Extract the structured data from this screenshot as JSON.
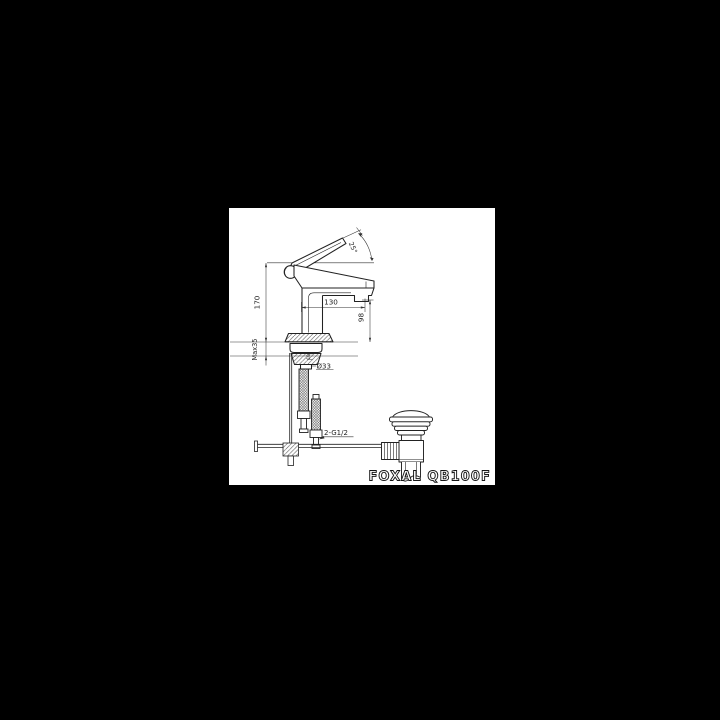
{
  "colors": {
    "background": "#000000",
    "paper": "#ffffff",
    "ink": "#1f1f1f",
    "dim_line": "#333333"
  },
  "drawing": {
    "product": "FOXAL QB100F",
    "dims": {
      "overall_height": "170",
      "max_deck": "Max35",
      "spout_reach": "130",
      "spout_height": "98",
      "handle_angle": "25°",
      "hole_dia": "Ø33",
      "shank": "10",
      "supply": "2-G1/2"
    }
  }
}
